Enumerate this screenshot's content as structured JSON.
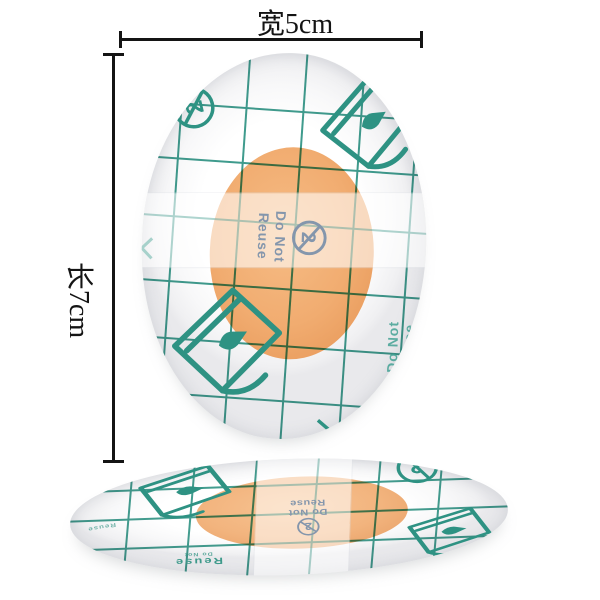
{
  "dimensions": {
    "width_label": "宽5cm",
    "length_label": "长7cm"
  },
  "print": {
    "do_not": "Do Not",
    "reuse": "Reuse",
    "no_reuse_number": "2"
  },
  "icons": {
    "no_reuse_icon": "circled-2-with-prohibition-slash",
    "peel_corner_icon": "liner-peel-hand-rectangle",
    "grid_print": "teal-measurement-grid"
  },
  "colors": {
    "grid_teal": "#2E9283",
    "print_blue_gray": "#8496AC",
    "pad_orange": "#F2AE73",
    "annotation_black": "#141414"
  }
}
